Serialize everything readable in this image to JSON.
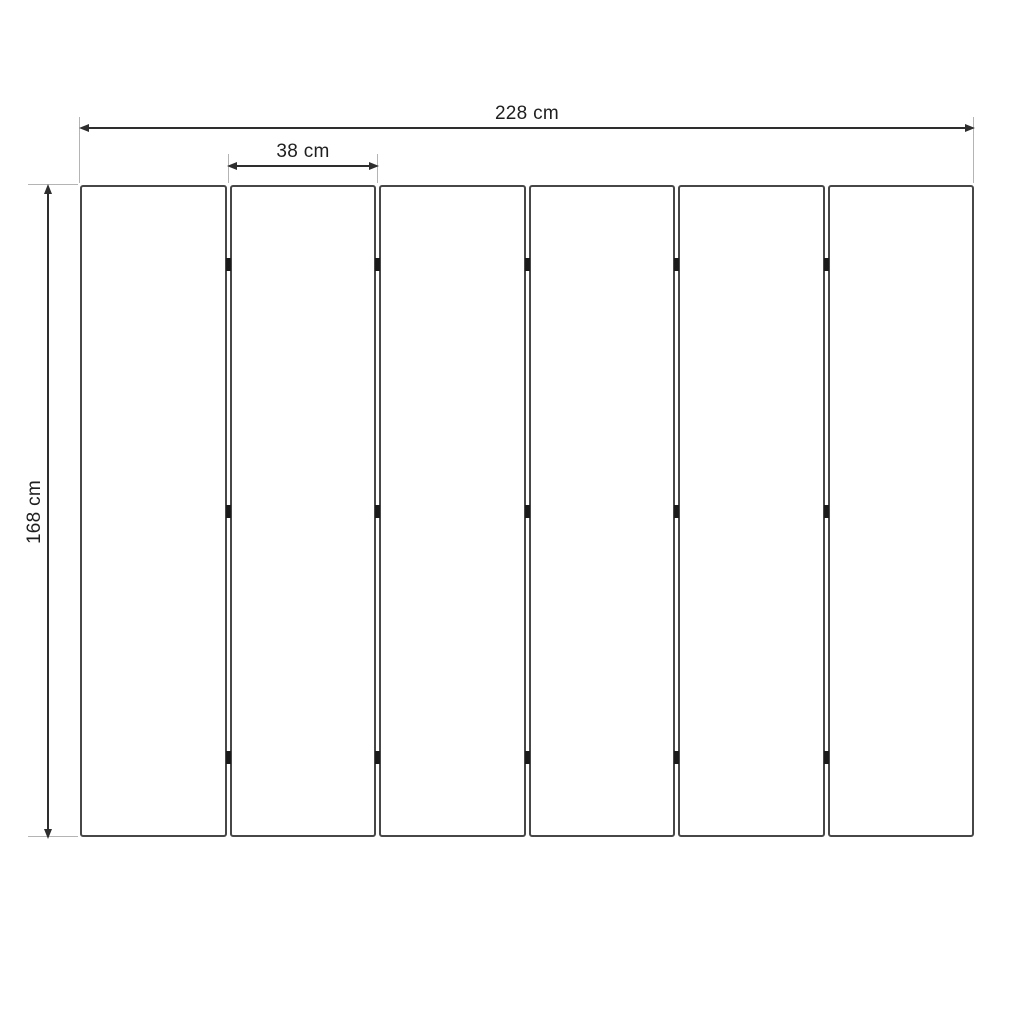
{
  "diagram": {
    "type": "technical-drawing",
    "subject": "six-panel folding screen, front elevation",
    "panel_count": 6,
    "hinges_per_divider": 3,
    "hinge_positions_fraction": [
      0.122,
      0.5,
      0.878
    ],
    "dimensions": {
      "total_width": {
        "label": "228 cm",
        "value": 228,
        "unit": "cm"
      },
      "panel_width": {
        "label": "38 cm",
        "value": 38,
        "unit": "cm"
      },
      "height": {
        "label": "168 cm",
        "value": 168,
        "unit": "cm"
      }
    },
    "colors": {
      "background": "#ffffff",
      "panel_fill": "#ffffff",
      "panel_border": "#474747",
      "dimension_line": "#2e2e2e",
      "extension_line": "#b4b4b4",
      "hinge": "#1a1a1a",
      "text": "#1f1f1f"
    }
  }
}
